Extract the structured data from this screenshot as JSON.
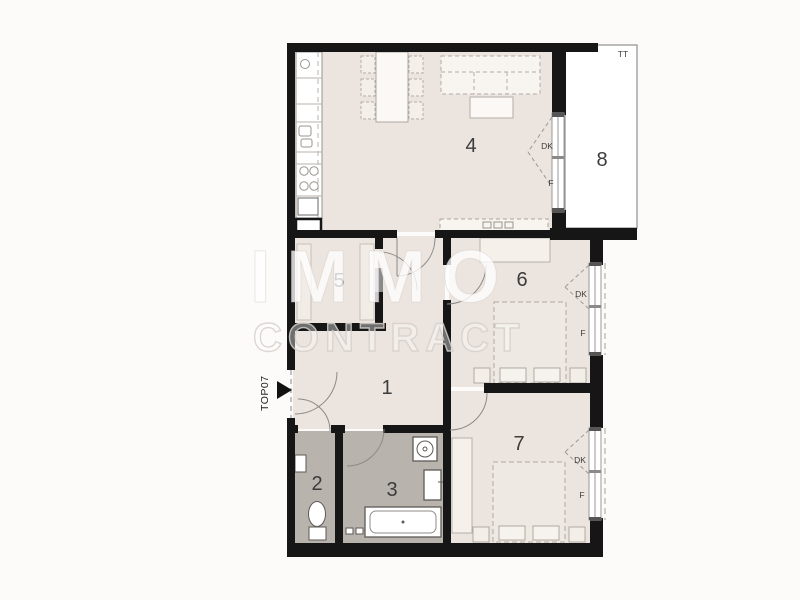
{
  "floor_plan": {
    "unit_label": "TOP07",
    "terrace_label": "TT",
    "watermark": {
      "line1": "IMMO",
      "line2": "CONTRACT"
    },
    "rooms": [
      {
        "number": "1"
      },
      {
        "number": "2"
      },
      {
        "number": "3"
      },
      {
        "number": "4"
      },
      {
        "number": "5"
      },
      {
        "number": "6"
      },
      {
        "number": "7"
      },
      {
        "number": "8"
      }
    ],
    "windows": [
      {
        "id": "living-balcony-door",
        "upper": "DK",
        "lower": "F"
      },
      {
        "id": "bedroom-6-window",
        "upper": "DK",
        "lower": "F"
      },
      {
        "id": "bedroom-7-window",
        "upper": "DK",
        "lower": "F"
      }
    ],
    "colors": {
      "wall": "#161616",
      "floor": "#ece4de",
      "wet_floor": "#b9b3ae",
      "balcony": "#ffffff",
      "background": "#fcfbf9"
    }
  }
}
